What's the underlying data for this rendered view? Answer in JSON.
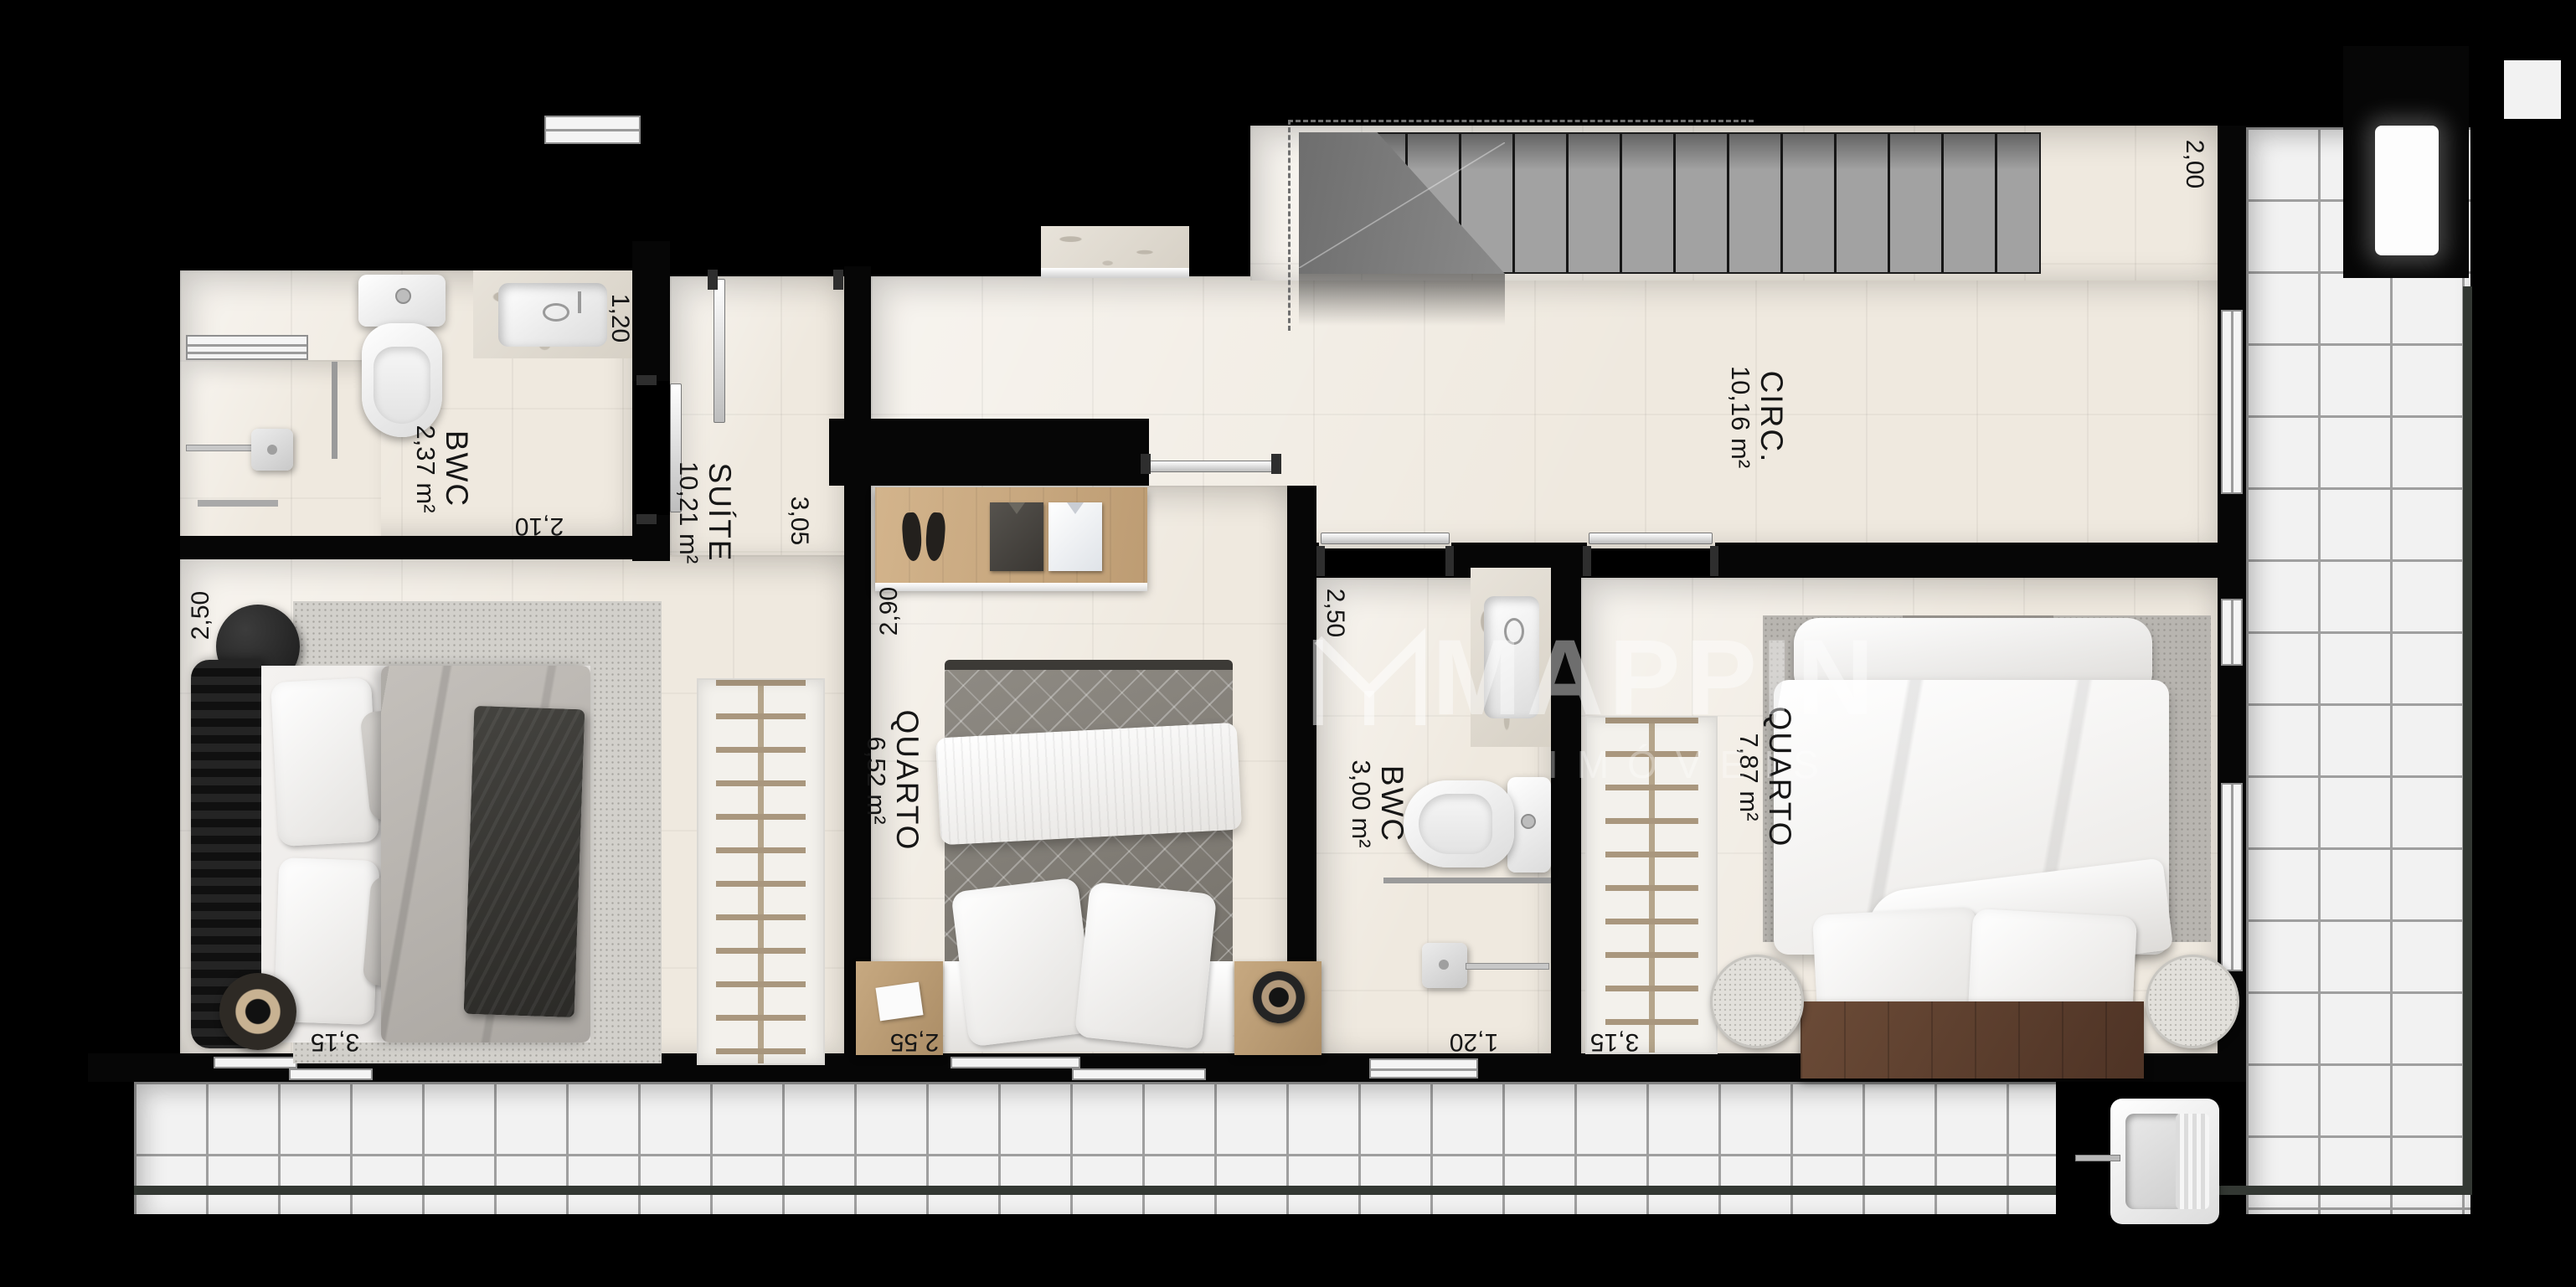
{
  "watermark": {
    "brand": "MAPPIN",
    "subtitle": "IMÓVEIS"
  },
  "rooms": {
    "bwc_suite": {
      "name": "BWC",
      "area": "2,37 m²"
    },
    "suite": {
      "name": "SUÍTE",
      "area": "10,21 m²"
    },
    "quarto1": {
      "name": "QUARTO",
      "area": "6,52 m²"
    },
    "bwc2": {
      "name": "BWC",
      "area": "3,00 m²"
    },
    "quarto2": {
      "name": "QUARTO",
      "area": "7,87 m²"
    },
    "circ": {
      "name": "CIRC.",
      "area": "10,16 m²"
    }
  },
  "dims": {
    "bwc_suite_side": "1,20",
    "bwc_suite_bottom": "2,10",
    "suite_hall": "3,05",
    "suite_left": "2,50",
    "suite_bottom": "3,15",
    "quarto1_left": "2,90",
    "quarto1_bottom": "2,55",
    "bwc2_left": "2,50",
    "bwc2_bottom": "1,20",
    "quarto2_bottom": "3,15",
    "circ_right": "2,00"
  },
  "colors": {
    "background": "#000000",
    "floor": "#efe9df",
    "terrace_tile": "#f2f2f2",
    "parapet": "#333833",
    "stair": "#a2a2a2",
    "wood": "#c8a87f",
    "bed_base_wood": "#5e4333",
    "watermark": "rgba(255,255,255,0.38)"
  }
}
